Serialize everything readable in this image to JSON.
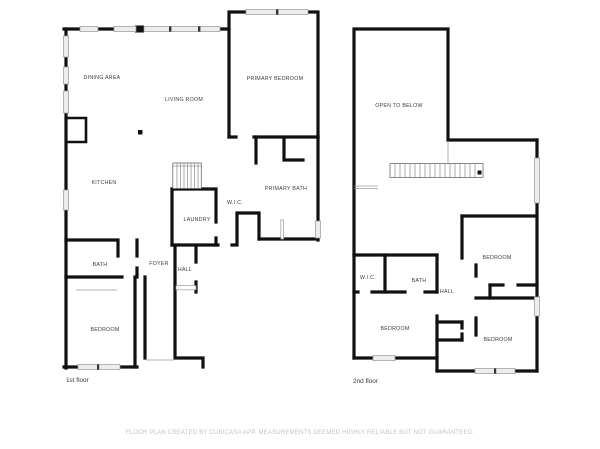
{
  "document_type": "floor-plan",
  "footer": {
    "disclaimer": "FLOOR PLAN CREATED BY CUBICASA APP. MEASUREMENTS DEEMED HIGHLY RELIABLE BUT NOT GUARANTEED."
  },
  "colors": {
    "bg": "#ffffff",
    "wall": "#111111",
    "win": "#ededed",
    "label": "#3d3d3d",
    "disc": "#c3c3c3"
  },
  "floors": [
    {
      "name": "1st floor",
      "rooms": [
        {
          "label": "DINING AREA",
          "x": 102,
          "y": 79
        },
        {
          "label": "LIVING ROOM",
          "x": 184,
          "y": 101
        },
        {
          "label": "PRIMARY BEDROOM",
          "x": 275,
          "y": 80
        },
        {
          "label": "KITCHEN",
          "x": 104,
          "y": 184
        },
        {
          "label": "PRIMARY BATH",
          "x": 286,
          "y": 190
        },
        {
          "label": "W.I.C.",
          "x": 235,
          "y": 204
        },
        {
          "label": "LAUNDRY",
          "x": 197,
          "y": 221
        },
        {
          "label": "BATH",
          "x": 100,
          "y": 266
        },
        {
          "label": "FOYER",
          "x": 159,
          "y": 265
        },
        {
          "label": "HALL",
          "x": 185,
          "y": 271
        },
        {
          "label": "BEDROOM",
          "x": 105,
          "y": 331
        }
      ]
    },
    {
      "name": "2nd floor",
      "rooms": [
        {
          "label": "OPEN TO BELOW",
          "x": 399,
          "y": 107
        },
        {
          "label": "BEDROOM",
          "x": 497,
          "y": 259
        },
        {
          "label": "W.I.C.",
          "x": 368,
          "y": 279
        },
        {
          "label": "BATH",
          "x": 419,
          "y": 282
        },
        {
          "label": "HALL",
          "x": 447,
          "y": 293
        },
        {
          "label": "BEDROOM",
          "x": 395,
          "y": 330
        },
        {
          "label": "BEDROOM",
          "x": 498,
          "y": 341
        }
      ]
    }
  ]
}
